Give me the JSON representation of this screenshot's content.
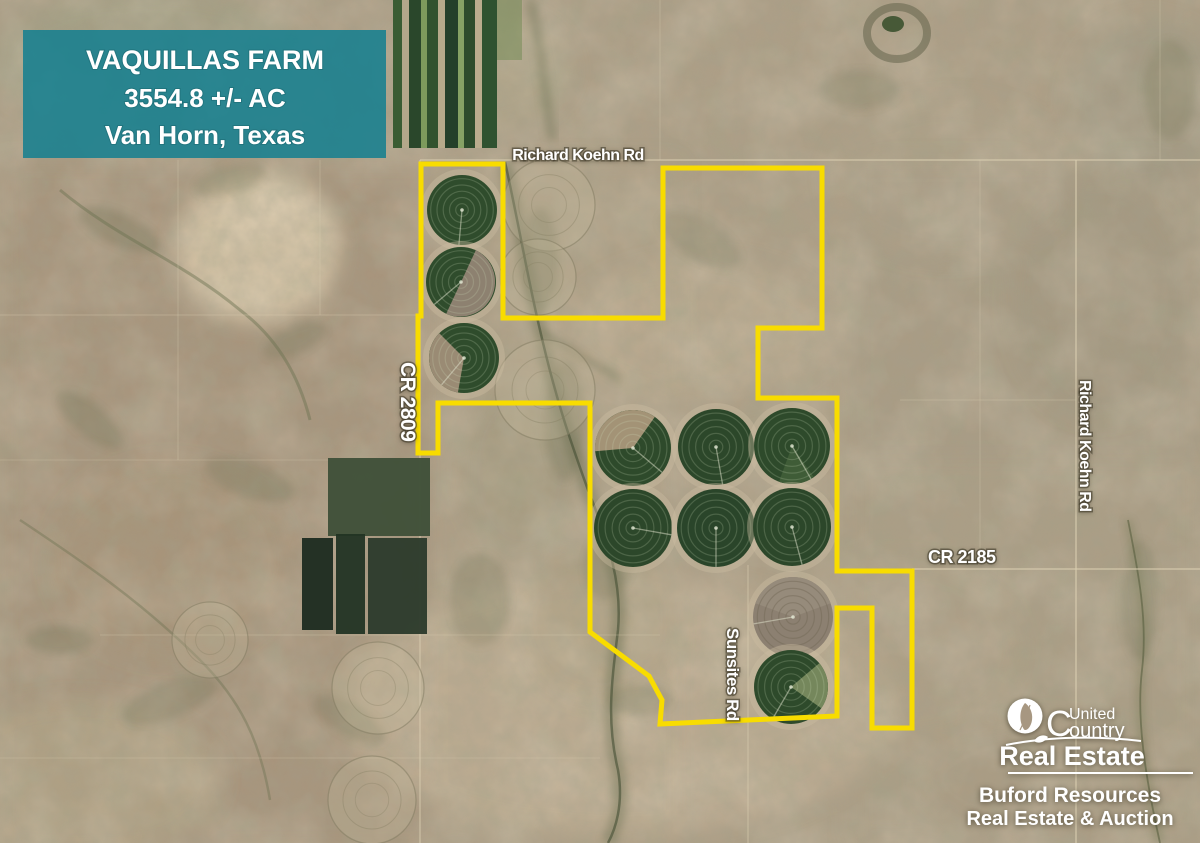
{
  "banner": {
    "title": "VAQUILLAS FARM",
    "acreage": "3554.8 +/- AC",
    "location": "Van Horn, Texas",
    "bg_color": "#17808f"
  },
  "roads": {
    "richard_koehn_top": "Richard Koehn Rd",
    "cr_2809": "CR 2809",
    "richard_koehn_right": "Richard Koehn Rd",
    "cr_2185": "CR 2185",
    "sunsites": "Sunsites Rd"
  },
  "logo": {
    "c": "C",
    "united": "United",
    "ountry": "ountry",
    "real_estate": "Real Estate",
    "line1": "Buford Resources",
    "line2": "Real Estate & Auction"
  },
  "map": {
    "boundary_color": "#f8dc00",
    "boundary_points": [
      [
        421,
        164
      ],
      [
        503,
        164
      ],
      [
        503,
        318
      ],
      [
        663,
        318
      ],
      [
        663,
        168
      ],
      [
        822,
        168
      ],
      [
        822,
        328
      ],
      [
        758,
        328
      ],
      [
        758,
        398
      ],
      [
        837,
        398
      ],
      [
        837,
        571
      ],
      [
        912,
        571
      ],
      [
        912,
        728
      ],
      [
        872,
        728
      ],
      [
        872,
        608
      ],
      [
        837,
        608
      ],
      [
        837,
        716
      ],
      [
        660,
        724
      ],
      [
        662,
        700
      ],
      [
        649,
        676
      ],
      [
        590,
        632
      ],
      [
        590,
        403
      ],
      [
        438,
        403
      ],
      [
        438,
        453
      ],
      [
        418,
        453
      ],
      [
        418,
        316
      ],
      [
        421,
        316
      ]
    ],
    "pivot_circles": [
      {
        "cx": 462,
        "cy": 210,
        "r": 35,
        "fill": "#2f4c2c",
        "wedges": [],
        "arm": 95
      },
      {
        "cx": 461,
        "cy": 282,
        "r": 35,
        "fill": "#2f4c2c",
        "wedges": [
          {
            "s": 295,
            "e": 115,
            "fill": "#8d8170"
          }
        ],
        "arm": 140
      },
      {
        "cx": 464,
        "cy": 358,
        "r": 35,
        "fill": "#2f4c2c",
        "wedges": [
          {
            "s": 100,
            "e": 225,
            "fill": "#9a8b74"
          }
        ],
        "arm": 130
      },
      {
        "cx": 633,
        "cy": 448,
        "r": 38,
        "fill": "#2e4a2b",
        "wedges": [
          {
            "s": 175,
            "e": 305,
            "fill": "#a39376"
          }
        ],
        "arm": 40
      },
      {
        "cx": 716,
        "cy": 447,
        "r": 38,
        "fill": "#2c472a",
        "wedges": [],
        "arm": 80
      },
      {
        "cx": 792,
        "cy": 446,
        "r": 38,
        "fill": "#2e4a2b",
        "wedges": [
          {
            "s": 55,
            "e": 110,
            "fill": "#3f5c37"
          }
        ],
        "arm": 60
      },
      {
        "cx": 633,
        "cy": 528,
        "r": 39,
        "fill": "#2c472a",
        "wedges": [],
        "arm": 10
      },
      {
        "cx": 716,
        "cy": 528,
        "r": 39,
        "fill": "#2a452a",
        "wedges": [],
        "arm": 90
      },
      {
        "cx": 792,
        "cy": 527,
        "r": 39,
        "fill": "#2c472a",
        "wedges": [],
        "arm": 75
      },
      {
        "cx": 793,
        "cy": 617,
        "r": 40,
        "fill": "#8c8071",
        "kind": "fallow",
        "wedges": [
          {
            "s": 200,
            "e": 340,
            "fill": "#968b7b"
          }
        ],
        "arm": 170
      },
      {
        "cx": 791,
        "cy": 687,
        "r": 37,
        "fill": "#2e4a2b",
        "wedges": [
          {
            "s": 320,
            "e": 35,
            "fill": "#75875c"
          }
        ],
        "arm": 120
      }
    ],
    "ghost_circles": [
      [
        549,
        205,
        46
      ],
      [
        538,
        277,
        38
      ],
      [
        545,
        390,
        50
      ],
      [
        378,
        688,
        46
      ],
      [
        372,
        800,
        44
      ],
      [
        210,
        640,
        38
      ]
    ],
    "strip_fields": {
      "x": 393,
      "y": 0,
      "h": 148,
      "strips": [
        [
          9,
          "#3a5c33"
        ],
        [
          7,
          "#b3a78a"
        ],
        [
          12,
          "#2a472b"
        ],
        [
          6,
          "#7d9a5c"
        ],
        [
          11,
          "#31522e"
        ],
        [
          7,
          "#b6aa8b"
        ],
        [
          13,
          "#24402a"
        ],
        [
          6,
          "#86a265"
        ],
        [
          11,
          "#2d4c2c"
        ],
        [
          7,
          "#baac8e"
        ],
        [
          15,
          "#2f5230"
        ]
      ]
    },
    "dark_fields": [
      [
        328,
        458,
        102,
        78,
        "#3e4f38"
      ],
      [
        302,
        538,
        31,
        92,
        "#1c2b20"
      ],
      [
        336,
        534,
        29,
        100,
        "#223424"
      ],
      [
        368,
        538,
        59,
        96,
        "#2b3a2b"
      ]
    ]
  }
}
